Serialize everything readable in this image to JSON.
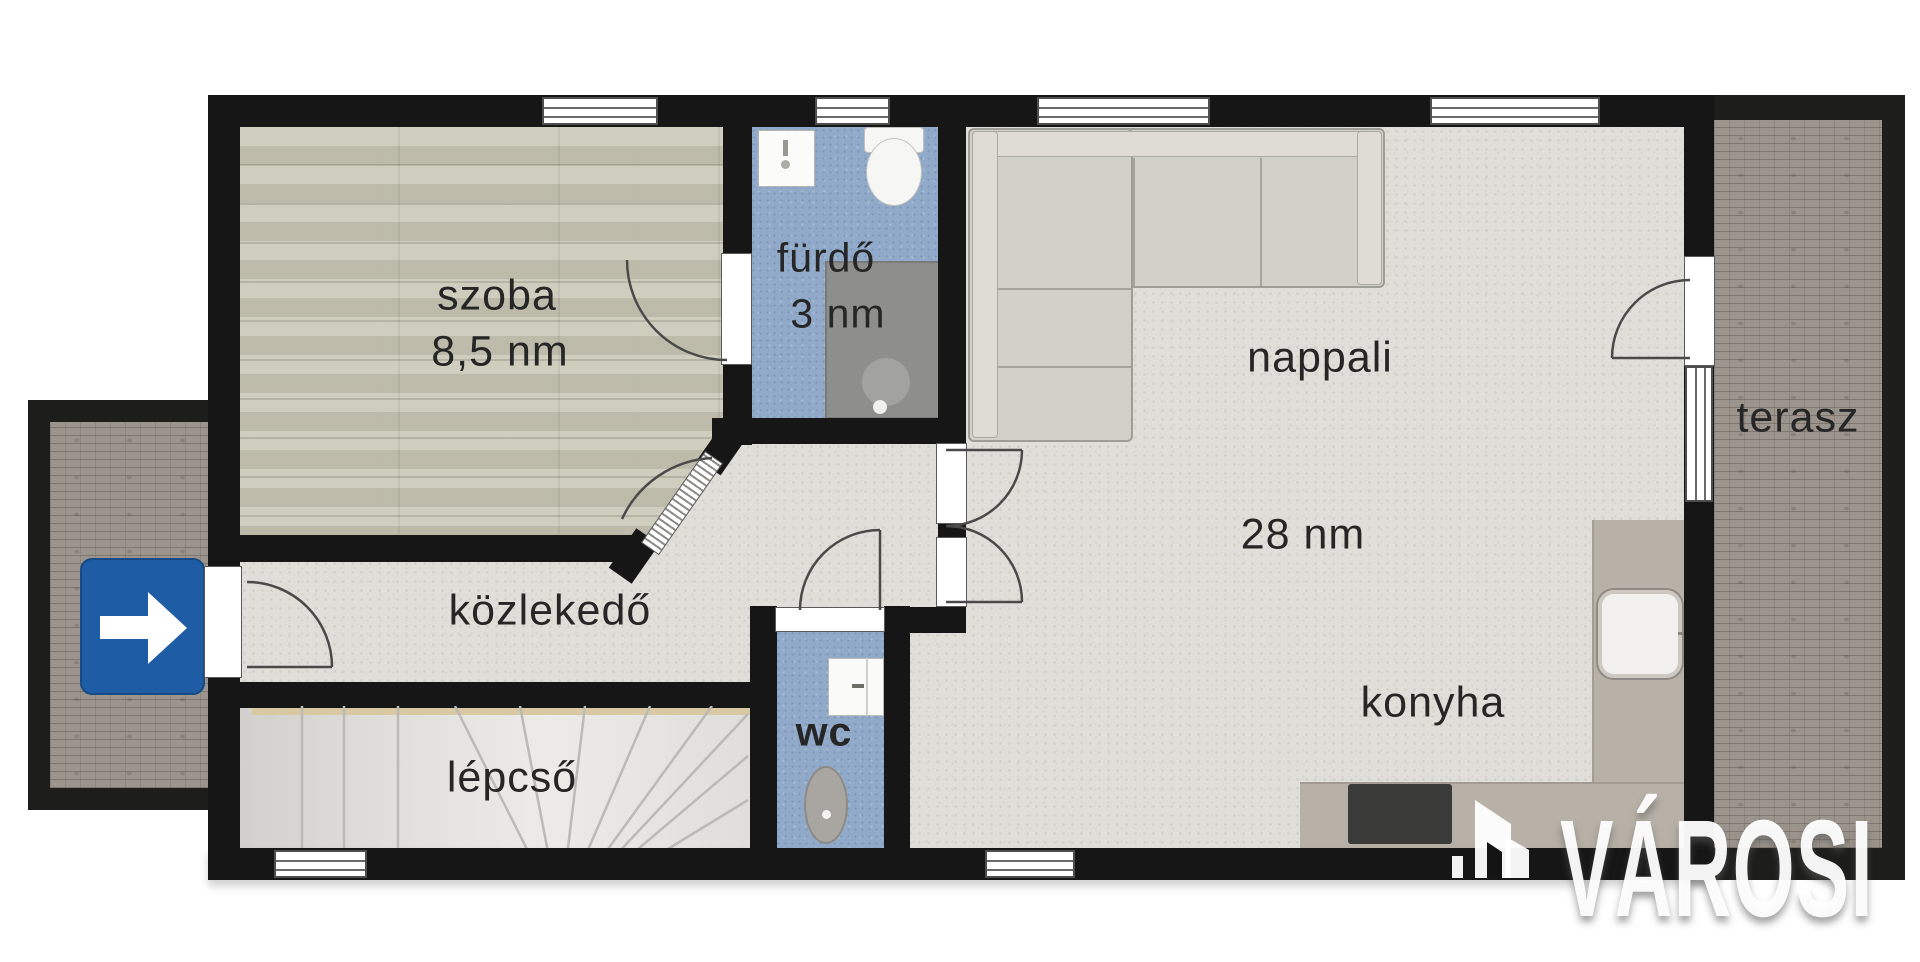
{
  "floor_plan": {
    "title": "apartment floor plan",
    "rooms": [
      {
        "id": "szoba",
        "label": "szoba",
        "area": "8,5 nm",
        "floor": "wood"
      },
      {
        "id": "furdo",
        "label": "fürdő",
        "area": "3 nm",
        "floor": "blue-tile"
      },
      {
        "id": "nappali",
        "label": "nappali",
        "area": "28 nm",
        "floor": "screed"
      },
      {
        "id": "kozlekedo",
        "label": "közlekedő",
        "floor": "screed"
      },
      {
        "id": "lepcso",
        "label": "lépcső",
        "floor": "stairs"
      },
      {
        "id": "wc",
        "label": "wc",
        "floor": "blue-tile"
      },
      {
        "id": "konyha",
        "label": "konyha",
        "floor": "screed"
      },
      {
        "id": "terasz",
        "label": "terasz",
        "floor": "brick"
      }
    ],
    "fixtures": [
      "sofa",
      "shower",
      "bathroom-sink",
      "toilet",
      "wc-toilet",
      "wc-basin",
      "kitchen-counter",
      "kitchen-sink",
      "cooktop",
      "stairs-fan"
    ],
    "entrance_sign": {
      "icon": "arrow-right-icon",
      "color": "#1f5ca6"
    },
    "colors": {
      "walls": "#161616",
      "screed_floor": "#e0ded8",
      "wood_floor": "#cac8b7",
      "tile_floor": "#92aac9",
      "brick": "#9c958d",
      "counter": "#b7b1a7",
      "sign_blue": "#1f5ca6"
    }
  },
  "watermark": {
    "text": "VÁROSI",
    "icon": "varosi-buildings-icon"
  }
}
